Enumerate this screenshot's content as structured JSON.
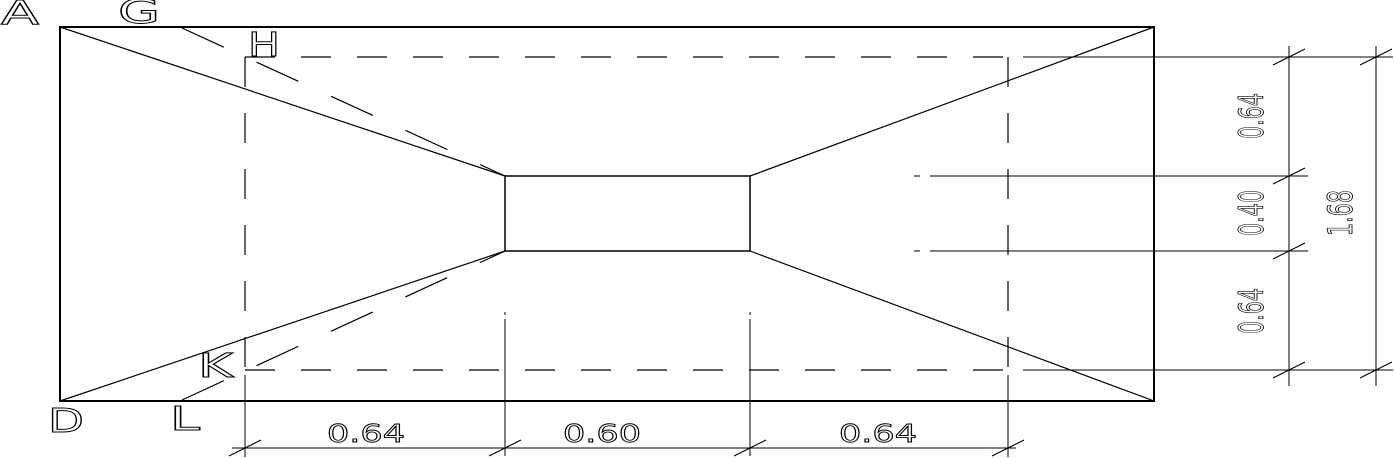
{
  "drawing": {
    "description": "Plan view of a stepped/pyramidal footing with central column and dimension chains",
    "background_color": "#ffffff",
    "line_color": "#000000",
    "point_labels": {
      "a": "A",
      "g": "G",
      "h": "H",
      "d": "D",
      "k": "K",
      "l": "L"
    },
    "dimensions": {
      "bottom": [
        "0.64",
        "0.60",
        "0.64"
      ],
      "right": [
        "0.64",
        "0.40",
        "0.64"
      ],
      "right_total": "1.68"
    }
  }
}
